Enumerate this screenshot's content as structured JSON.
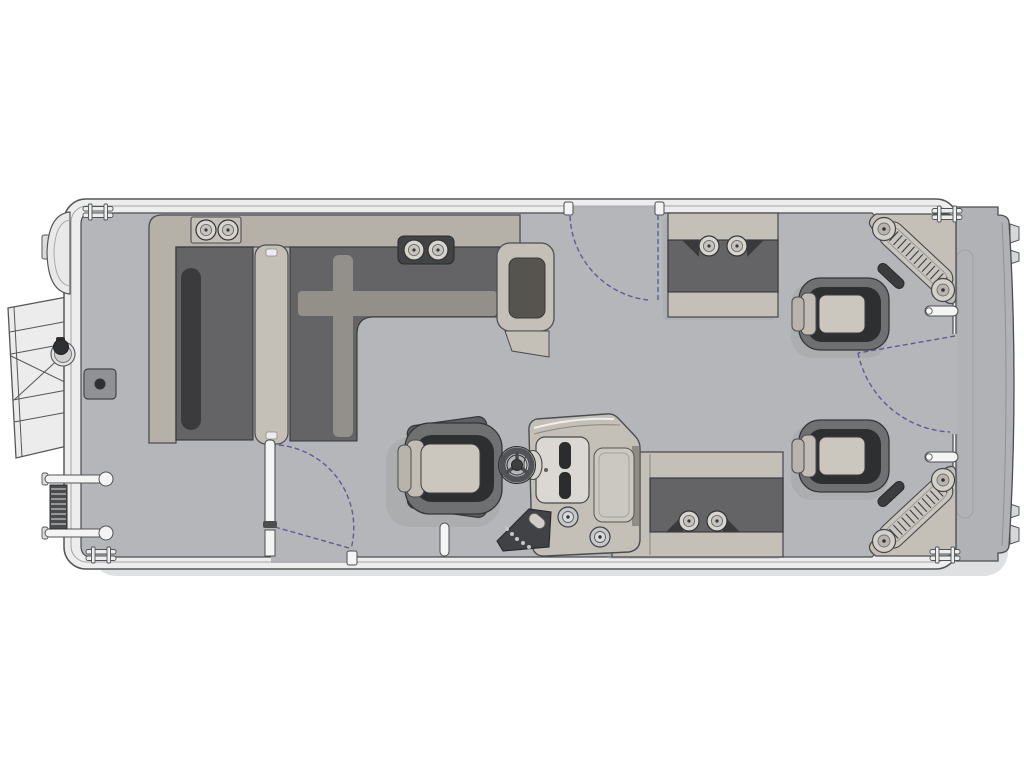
{
  "diagram": {
    "label": "Pontoon boat floor plan - overhead view",
    "type": "boat-floorplan",
    "regions": {
      "bow": [
        "boarding-ramp",
        "bow-nose-cone",
        "l-shaped-lounge",
        "lounge-cup-holders",
        "table-base"
      ],
      "midship": [
        "port-bow-gate",
        "helm-console",
        "steering-wheel",
        "captain-chair",
        "switch-panel",
        "deck-cup-holders",
        "top-entry-gate"
      ],
      "stern": [
        "port-aft-bench",
        "starboard-aft-bench",
        "recliner-seat-port",
        "recliner-seat-starboard",
        "corner-step-pad-port",
        "corner-step-pad-starboard",
        "stern-gate",
        "stern-platform",
        "boarding-ladder",
        "mooring-cleats"
      ]
    },
    "counts": {
      "recliner_seats": 2,
      "corner_step_pads": 2,
      "mooring_cleats": 4,
      "entry_gates": 3,
      "cup_holders": 10
    }
  },
  "palette": {
    "page-bg": "#ffffff",
    "hull": "#ededee",
    "hull-line": "#54575a",
    "deck": "#b4b6b9",
    "deck-line": "#4b4e51",
    "fence": "#f4f4f5",
    "platform": "#b0b2b5",
    "furn-light": "#c4c0b8",
    "furn-back": "#b5b0a8",
    "cushion-dark": "#646466",
    "cushion-darker": "#3b3b3d",
    "shell": "#6f7072",
    "seat-light": "#ccc7be",
    "tray-dark": "#424345",
    "gate-dash": "#5d5d95",
    "shadow": "#dfe0e2"
  }
}
